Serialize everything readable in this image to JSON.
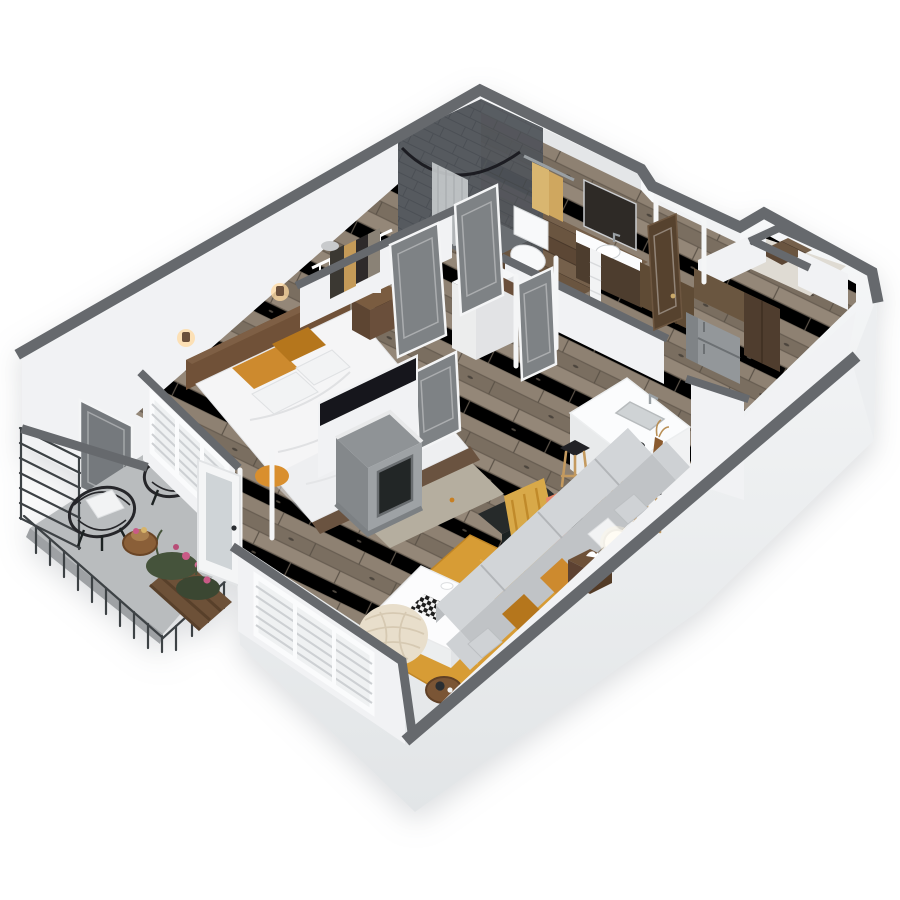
{
  "scene": {
    "kind": "isometric-3d-apartment-floor-plan-render",
    "rooms_depicted": [
      "bedroom",
      "walk-in-closet",
      "bathroom",
      "hallway",
      "entry",
      "kitchen",
      "living-room",
      "balcony"
    ],
    "objects_depicted": [
      "bed",
      "headboard",
      "orange-pillows",
      "nightstand",
      "wall-sconces",
      "bedroom-rug",
      "wire-closet-shelving",
      "hanging-clothes",
      "shower",
      "shower-curtain",
      "toilet",
      "towel-bar",
      "towels",
      "vanity",
      "mirror",
      "interior-doors",
      "front-door",
      "refrigerator",
      "wood-cabinets",
      "kitchen-island",
      "sink",
      "faucet",
      "fruit-bowl",
      "vase",
      "bar-stools",
      "tv-panel",
      "fireplace",
      "living-rug",
      "coffee-table",
      "checkerboard",
      "tufted-pouf",
      "accent-chair",
      "throw-blanket",
      "sofa",
      "sofa-pillows",
      "side-table",
      "sphere-lamp",
      "round-side-table",
      "window-blinds",
      "french-door",
      "balcony-chairs",
      "balcony-pillows",
      "balcony-table",
      "planters",
      "flowers",
      "railing",
      "privacy-screen"
    ]
  },
  "palette": {
    "background": "#ffffff",
    "wall_cap": "#66696d",
    "wall_white": "#f1f2f4",
    "wall_shade": "#e4e6e8",
    "skirt_top": "#fafbfc",
    "skirt_bottom": "#e2e5e7",
    "wood_light": "#948778",
    "wood_mid": "#8e8172",
    "wood_dark": "#7a6e60",
    "wood_seam": "#675d51",
    "wood_bath": "#6a5440",
    "balcony_floor": "#b9bcbe",
    "railing": "#3e4245",
    "door_gray": "#7e8285",
    "door_frame": "#f4f5f6",
    "front_door": "#57422f",
    "tile_dark": "#565a5f",
    "tile_grout": "#4b4f54",
    "curtain": "#c8cbcd",
    "towel": "#d9b66f",
    "porcelain": "#f8f9fa",
    "vanity_wood": "#4e3c2e",
    "mirror": "#2e2b28",
    "rug_living": "#d79c35",
    "rug_bedroom": "#b5ae9f",
    "sofa_back": "#c0c3c6",
    "sofa_seat": "#d2d5d8",
    "pillow_orange": "#cd8a2e",
    "pillow_orange_dark": "#b5761f",
    "duvet": "#f5f5f6",
    "headboard": "#6f5137",
    "nightstand": "#6b503a",
    "pouf": "#e8decb",
    "chair_black": "#232527",
    "throw_mustard": "#d8a94a",
    "throw_salmon": "#e8866a",
    "island_top": "#fbfcfd",
    "island_side": "#e9ebec",
    "stool_seat": "#212326",
    "stool_leg": "#c49a5f",
    "fridge": "#93979a",
    "cabinet_wood": "#5f4b36",
    "fireplace": "#949899",
    "fireplace_dark": "#2a2c2e",
    "tv_black": "#17181a",
    "sconce_glow": "#ffd9a0",
    "plant_green": "#45523a",
    "flower_pink": "#c95a86"
  }
}
